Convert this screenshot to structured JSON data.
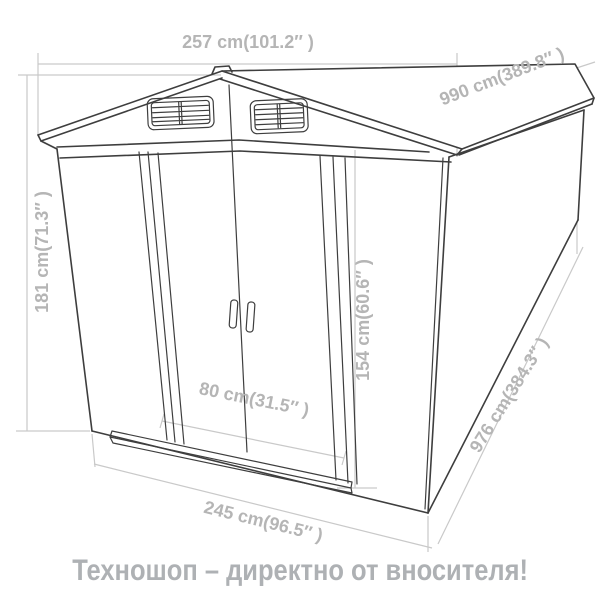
{
  "diagram": {
    "description": "Technical line drawing of a metal garden shed with gable roof, two louvered gable vents and double sliding doors, annotated with dimensions",
    "labels": {
      "width_top": "257 cm(101.2″ )",
      "roof_length": "990 cm(389.8″ )",
      "height": "181 cm(71.3″ )",
      "door_height": "154 cm(60.6″ )",
      "door_width": "80 cm(31.5″ )",
      "width_bottom": "245 cm(96.5″ )",
      "base_length": "976 cm(384.3″ )"
    },
    "colors": {
      "outline": "#3e3e3e",
      "dimension_lines": "#c9c9c9",
      "dimension_text": "#b5b5b5",
      "caption_text": "#aeb1b4",
      "background": "#ffffff"
    }
  },
  "caption": {
    "text": "Техношоп – директно от вносителя!"
  }
}
